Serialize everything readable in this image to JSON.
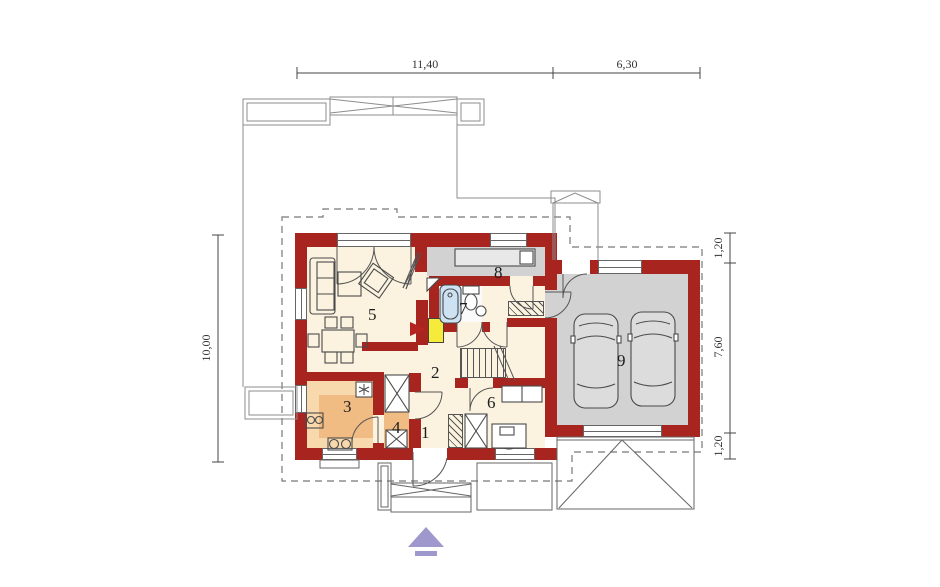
{
  "dimensions": {
    "top": [
      {
        "label": "11,40"
      },
      {
        "label": "6,30"
      }
    ],
    "left": [
      {
        "label": "10,00"
      }
    ],
    "right": [
      {
        "label": "1,20"
      },
      {
        "label": "7,60"
      },
      {
        "label": "1,20"
      }
    ]
  },
  "rooms": [
    {
      "number": "1"
    },
    {
      "number": "2"
    },
    {
      "number": "3"
    },
    {
      "number": "4"
    },
    {
      "number": "5"
    },
    {
      "number": "6"
    },
    {
      "number": "7"
    },
    {
      "number": "8"
    },
    {
      "number": "9"
    }
  ],
  "colors": {
    "wall": "#a8241f",
    "floor_main": "#fbf3e0",
    "floor_kitchen": "#f1bc83",
    "kitchen_counter": "#f8d9ad",
    "floor_utility_garage": "#d2d2d2",
    "bathtub": "#cde2f3",
    "fireplace": "#f6ea3a",
    "north_arrow": "#9e98cc"
  },
  "icons": {
    "north_arrow": "north-arrow-icon",
    "fireplace_flue": "fireplace-arrow-icon",
    "fridge": "snowflake-icon"
  }
}
